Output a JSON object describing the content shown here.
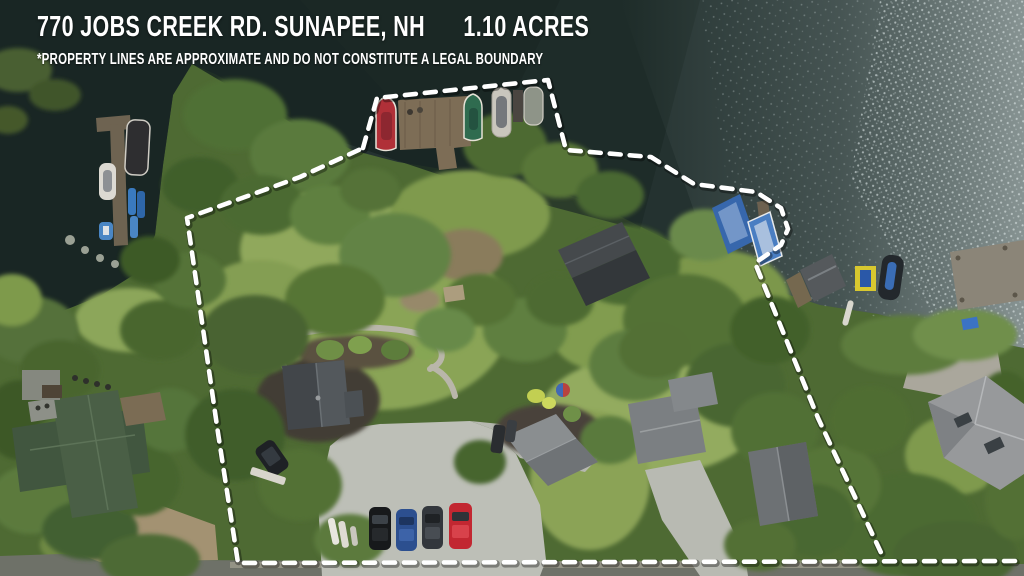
{
  "overlay": {
    "address": "770 JOBS CREEK RD. SUNAPEE, NH",
    "acreage": "1.10 ACRES",
    "disclaimer": "*PROPERTY LINES ARE APPROXIMATE AND DO NOT CONSTITUTE A LEGAL BOUNDARY"
  },
  "scene": {
    "type": "aerial-drone-photo",
    "subject": "lakefront wooded lot outlined with dashed approximate property boundary",
    "boundary_color": "#ffffff",
    "water_dark_color": "#1c2826",
    "water_sparkle_color": "#b9c4c4",
    "features": [
      "lake water with sun sparkle",
      "main wooden dock with red boat, green boat and two covered boats",
      "two blue boats at small dock",
      "neighbor T-dock with pontoon, white boat, blue kayaks",
      "right-side docks with pontoon boat and yellow jet-ski lift",
      "dark gray roofed lakeside cottage",
      "main house with dark gray roof and garden walkway loop",
      "gray roofed cottages along driveway",
      "large green cross-gable house lower left",
      "light gray hip-roof house lower right",
      "gravel parking area with black, blue, gray and red cars",
      "white dashed property line"
    ]
  }
}
